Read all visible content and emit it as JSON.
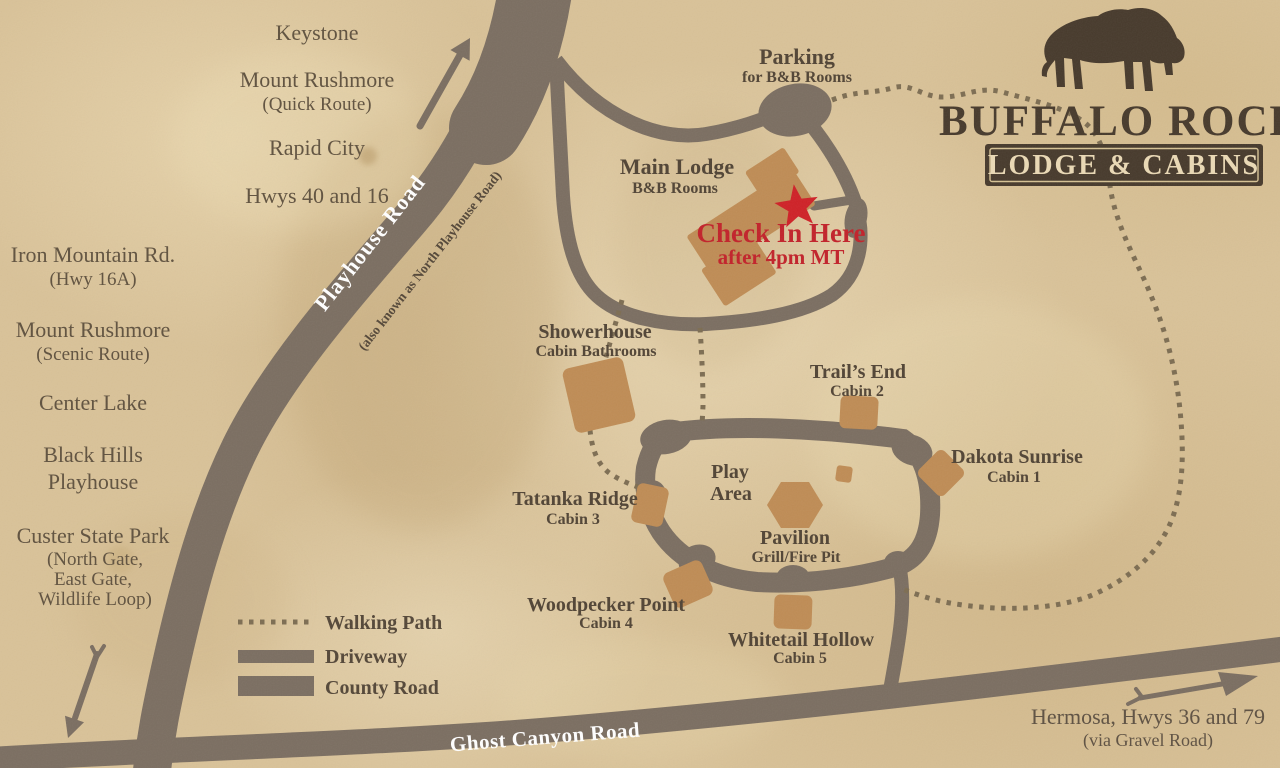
{
  "logo": {
    "title": "BUFFALO ROCK",
    "banner": "LODGE & CABINS"
  },
  "destinations": [
    {
      "line1": "Keystone"
    },
    {
      "line1": "Mount Rushmore",
      "line2": "(Quick Route)"
    },
    {
      "line1": "Rapid City"
    },
    {
      "line1": "Hwys 40 and 16"
    },
    {
      "line1": "Iron Mountain Rd.",
      "line2": "(Hwy 16A)"
    },
    {
      "line1": "Mount Rushmore",
      "line2": "(Scenic Route)"
    },
    {
      "line1": "Center Lake"
    },
    {
      "line1": "Black Hills",
      "line2": "Playhouse"
    },
    {
      "line1": "Custer State Park",
      "line2": "(North Gate,",
      "line3": "East Gate,",
      "line4": "Wildlife Loop)"
    }
  ],
  "roads": {
    "playhouse": "Playhouse Road",
    "playhouse_alt": "(also known as North Playhouse Road)",
    "ghost_canyon": "Ghost Canyon Road",
    "hermosa": "Hermosa, Hwys 36 and 79",
    "hermosa_note": "(via Gravel Road)"
  },
  "lodge": {
    "parking": "Parking",
    "parking_note": "for B&B Rooms",
    "main_lodge": "Main Lodge",
    "main_lodge_note": "B&B Rooms",
    "check_in": "Check In Here",
    "check_in_note": "after 4pm MT"
  },
  "facilities": {
    "showerhouse": "Showerhouse",
    "showerhouse_note": "Cabin Bathrooms",
    "play_area_line1": "Play",
    "play_area_line2": "Area",
    "pavilion": "Pavilion",
    "pavilion_note": "Grill/Fire Pit"
  },
  "cabins": [
    {
      "name": "Dakota Sunrise",
      "note": "Cabin 1"
    },
    {
      "name": "Trail’s End",
      "note": "Cabin 2"
    },
    {
      "name": "Tatanka Ridge",
      "note": "Cabin 3"
    },
    {
      "name": "Woodpecker Point",
      "note": "Cabin 4"
    },
    {
      "name": "Whitetail Hollow",
      "note": "Cabin 5"
    }
  ],
  "legend": [
    {
      "label": "Walking Path"
    },
    {
      "label": "Driveway"
    },
    {
      "label": "County Road"
    }
  ],
  "colors": {
    "parchment": "#d9c298",
    "road": "#7b6e61",
    "building": "#bf8c55",
    "text_dark": "#514435",
    "logo_dark": "#473a2c",
    "accent_red": "#c2222a",
    "walking_path_dot": "#7d6d52",
    "road_label": "#ffffff"
  }
}
